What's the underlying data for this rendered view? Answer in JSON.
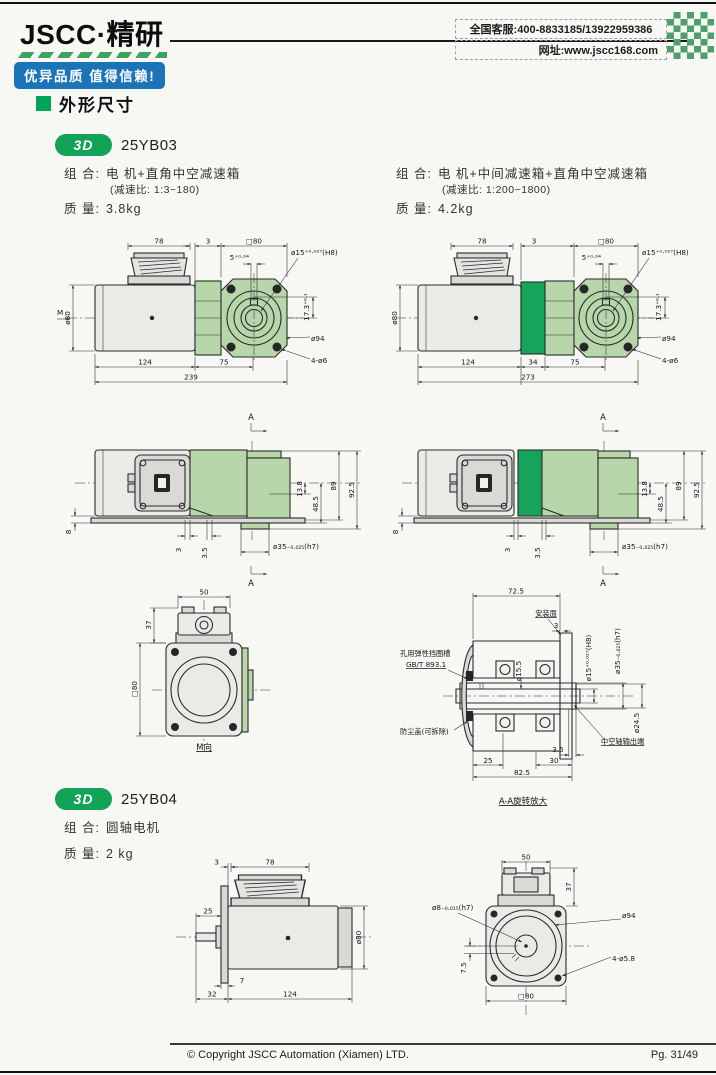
{
  "colors": {
    "brand_green": "#12a359",
    "light_green": "#b7d6a9",
    "dark_green": "#16a35a",
    "badge_blue": "#1b74b8"
  },
  "header": {
    "logo": "JSCC·精研",
    "slogan": "优异品质 值得信赖!",
    "service_line": "全国客服:400-8833185/13922959386",
    "website_line": "网址:www.jscc168.com"
  },
  "section": {
    "title": "外形尺寸"
  },
  "model1": {
    "badge": "3D",
    "name": "25YB03",
    "left": {
      "combo_label": "组 合:",
      "combo": "电 机+直角中空减速箱",
      "ratio": "(减速比: 1:3~180)",
      "mass_label": "质 量:",
      "mass": "3.8kg"
    },
    "right": {
      "combo_label": "组 合:",
      "combo": "电 机+中间减速箱+直角中空减速箱",
      "ratio": "(减速比: 1:200~1800)",
      "mass_label": "质 量:",
      "mass": "4.2kg"
    }
  },
  "model2": {
    "badge": "3D",
    "name": "25YB04",
    "combo_label": "组 合:",
    "combo": "圆轴电机",
    "mass_label": "质 量:",
    "mass": "2 kg"
  },
  "d1": {
    "dim78": "78",
    "dim3": "3",
    "sq80": "□80",
    "key": "5⁺⁰·⁰⁴",
    "bore": "ø15⁺⁰·⁰²⁷(H8)",
    "h173": "17.3⁺⁰·¹",
    "d80": "ø80",
    "m": "M",
    "b124": "124",
    "b75": "75",
    "b239": "239",
    "d94": "ø94",
    "holes": "4-ø6"
  },
  "d2": {
    "dim78": "78",
    "dim3": "3",
    "sq80": "□80",
    "key": "5⁺⁰·⁰⁴",
    "bore": "ø15⁺⁰·⁰²⁷(H8)",
    "h173": "17.3⁺⁰·¹",
    "d80": "ø80",
    "b124": "124",
    "b34": "34",
    "b75": "75",
    "b273": "273",
    "d94": "ø94",
    "holes": "4-ø6"
  },
  "d3": {
    "a": "A",
    "d8": "8",
    "d3": "3",
    "d35": "3.5",
    "d138": "13.8",
    "d485": "48.5",
    "d89": "89",
    "d925": "92.5",
    "shaft": "ø35₋₀.₀₂₅(h7)"
  },
  "d4": {
    "a": "A",
    "d8": "8",
    "d3": "3",
    "d35": "3.5",
    "d138": "13.8",
    "d485": "48.5",
    "d89": "89",
    "d925": "92.5",
    "shaft": "ø35₋₀.₀₂₅(h7)"
  },
  "d5": {
    "w50": "50",
    "h37": "37",
    "sq80": "□80",
    "title": "M向"
  },
  "d6": {
    "w725": "72.5",
    "mount": "安装面",
    "d3": "3",
    "bore155": "ø15.5",
    "bore": "ø15⁺⁰·⁰²⁷(H8)",
    "shaft": "ø35₋₀.₀₂₅(h7)",
    "d245": "ø24.5",
    "circlip1": "孔用弹性挡圈槽",
    "circlip2": "GB/T 893.1",
    "dust": "防尘盖(可拆除)",
    "hollow": "中空轴输出端",
    "d35": "3.5",
    "b25": "25",
    "b30": "30",
    "b825": "82.5",
    "title": "A-A旋转放大"
  },
  "d7": {
    "d3": "3",
    "d78": "78",
    "d25": "25",
    "d80": "ø80",
    "d7": "7",
    "b32": "32",
    "b124": "124"
  },
  "d8": {
    "w50": "50",
    "h37": "37",
    "shaft": "ø8₋₀.₀₁₅(h7)",
    "d94": "ø94",
    "holes": "4-ø5.8",
    "d75": "7.5",
    "sq80": "□80"
  },
  "footer": {
    "copyright": "© Copyright JSCC Automation (Xiamen) LTD.",
    "page": "Pg. 31/49"
  }
}
